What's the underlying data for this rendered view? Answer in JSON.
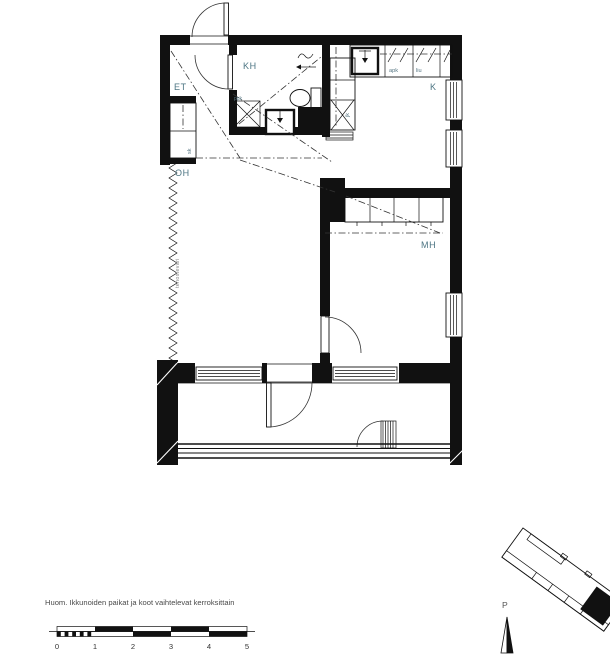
{
  "rooms": {
    "et": "ET",
    "kh": "KH",
    "oh": "OH",
    "mh": "MH",
    "k": "K"
  },
  "fixtures": {
    "sk": "sk",
    "jk": "jk",
    "ppk": "ppk",
    "apk": "apk",
    "liu": "liu",
    "accent_wall": "tehosteväri"
  },
  "note": "Huom. Ikkunoiden paikat ja koot vaihtelevat kerroksittain",
  "scale_bar": {
    "unit_labels": [
      "0",
      "1",
      "2",
      "3",
      "4",
      "5"
    ]
  },
  "site": {
    "north": "P"
  },
  "colors": {
    "line": "#111111",
    "room_label": "#4d7583",
    "fixture_label": "#567683",
    "note_text": "#4a4a4a"
  }
}
